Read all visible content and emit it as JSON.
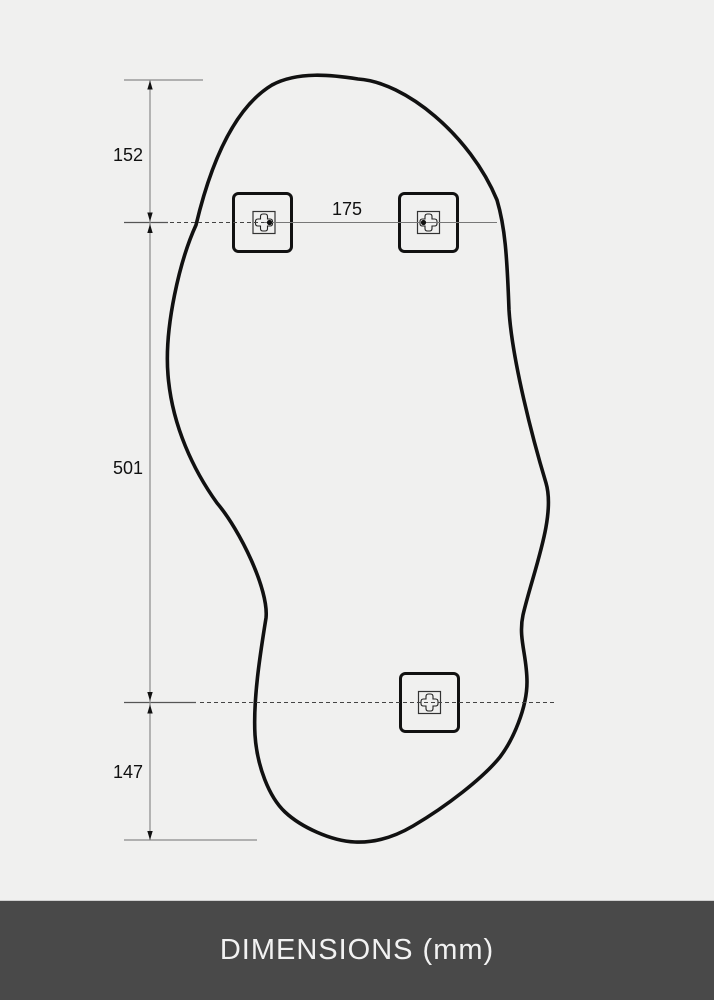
{
  "diagram": {
    "measurements": {
      "top_edge_to_bracket_line": "152",
      "bracket_line_vertical_span": "501",
      "bottom_bracket_to_bottom_edge": "147",
      "top_bracket_spacing": "175"
    }
  },
  "footer": {
    "title": "DIMENSIONS (mm)"
  },
  "colors": {
    "background": "#f0f0ef",
    "outline_black": "#111111",
    "dimension_line_gray": "#8a8a8a",
    "dashed_line_gray": "#444444",
    "footer_background": "#494949",
    "footer_text": "#f2f2f2"
  }
}
